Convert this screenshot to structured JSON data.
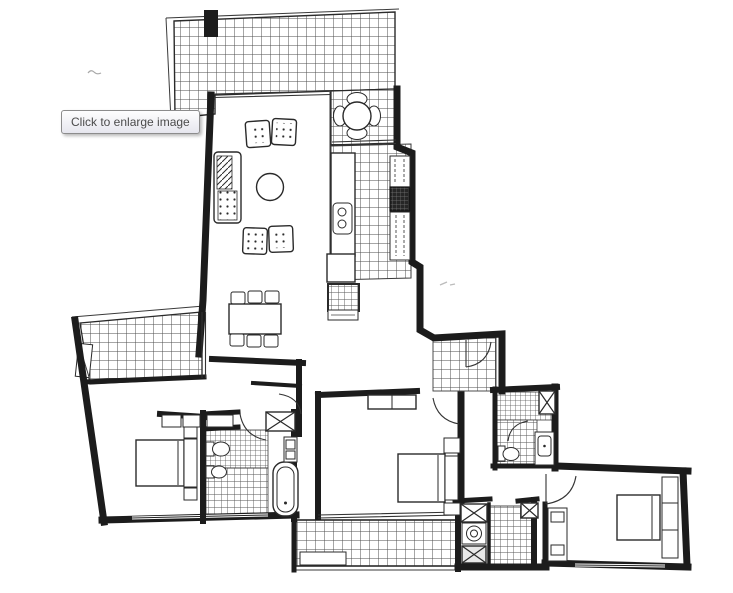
{
  "tooltip": {
    "text": "Click to enlarge image"
  },
  "image": {
    "description": "Black-and-white scanned apartment floor plan with three bedrooms, two bathrooms, kitchen, living-dining area and three tiled balconies",
    "interaction_hint": "Click to enlarge image"
  },
  "colors": {
    "paper": "#ffffff",
    "ink": "#1c1c1c",
    "tile_line": "#4d4d4d",
    "tooltip_border": "#8c8c8c",
    "tooltip_text": "#4b4b4b",
    "tooltip_bg_top": "#fefefe",
    "tooltip_bg_bottom": "#e6e6ee"
  }
}
